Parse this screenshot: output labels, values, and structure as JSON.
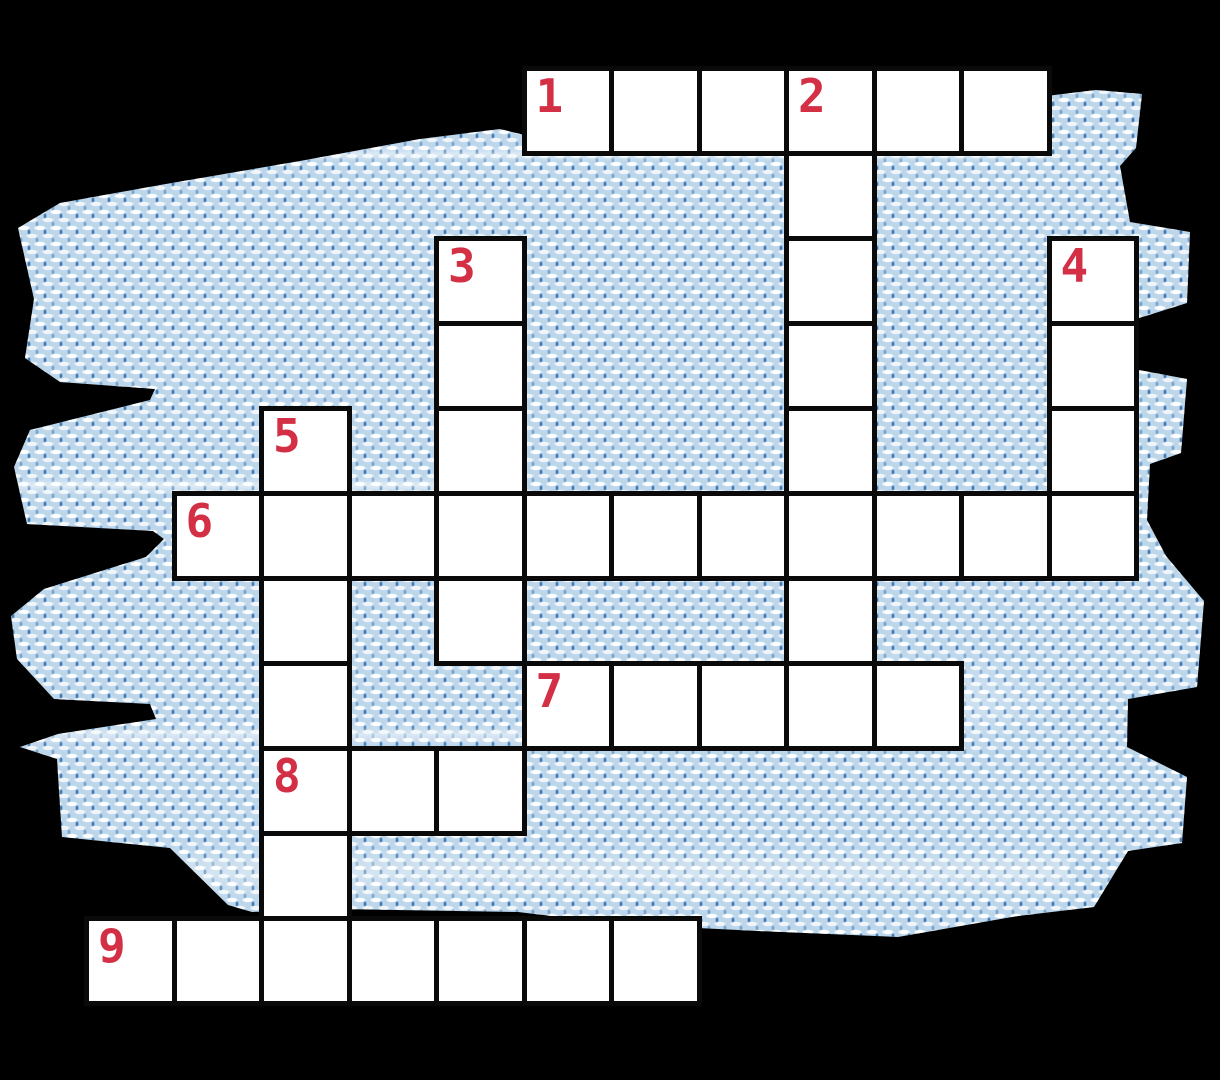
{
  "page": {
    "description": "Blank numbered crossword puzzle laid over a torn light-blue denim fabric swatch on a black background"
  },
  "colors": {
    "background": "#000000",
    "cell_fill": "#ffffff",
    "cell_border": "#0a0a0a",
    "clue_number": "#d32f45",
    "fabric_base": "#bdd6ea",
    "fabric_weave_white": "#fdfeff",
    "fabric_weave_blue": "#2f6fae"
  },
  "grid": {
    "origin_x": 84,
    "origin_y": 66,
    "pitch_x": 87.5,
    "pitch_y": 85,
    "cell_w": 92.5,
    "cell_h": 90
  },
  "words": [
    {
      "number": "1",
      "direction": "across",
      "row": 0,
      "col": 5,
      "length": 6
    },
    {
      "number": "2",
      "direction": "down",
      "row": 0,
      "col": 8,
      "length": 8
    },
    {
      "number": "3",
      "direction": "down",
      "row": 2,
      "col": 4,
      "length": 5
    },
    {
      "number": "4",
      "direction": "down",
      "row": 2,
      "col": 11,
      "length": 4
    },
    {
      "number": "5",
      "direction": "down",
      "row": 4,
      "col": 2,
      "length": 7
    },
    {
      "number": "6",
      "direction": "across",
      "row": 5,
      "col": 1,
      "length": 11
    },
    {
      "number": "7",
      "direction": "across",
      "row": 7,
      "col": 5,
      "length": 5
    },
    {
      "number": "8",
      "direction": "across",
      "row": 8,
      "col": 2,
      "length": 3
    },
    {
      "number": "9",
      "direction": "across",
      "row": 10,
      "col": 0,
      "length": 7
    }
  ]
}
